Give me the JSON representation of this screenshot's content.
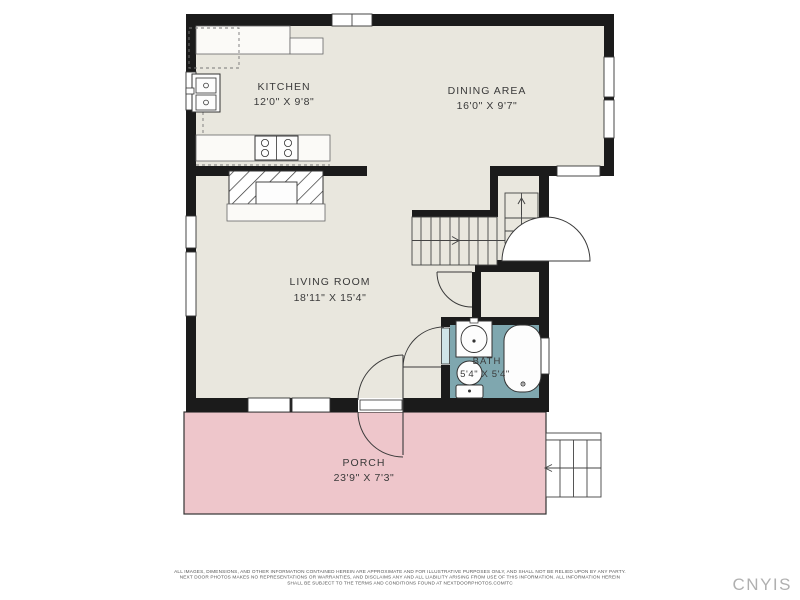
{
  "plan": {
    "rooms": [
      {
        "name": "KITCHEN",
        "dims": "12'0\" X 9'8\""
      },
      {
        "name": "DINING AREA",
        "dims": "16'0\" X 9'7\""
      },
      {
        "name": "LIVING ROOM",
        "dims": "18'11\" X 15'4\""
      },
      {
        "name": "BATH",
        "dims": "5'4\" X 5'4\""
      },
      {
        "name": "PORCH",
        "dims": "23'9\" X 7'3\""
      }
    ],
    "features": [
      "staircase-up",
      "basement-stair-door",
      "fireplace",
      "kitchen-sink",
      "range-stove",
      "bath-sink",
      "toilet",
      "bathtub",
      "front-entry-door",
      "porch-steps"
    ],
    "colors": {
      "wall": "#1b1b1b",
      "floor": "#e9e7de",
      "bath_floor": "#7fa7af",
      "porch_floor": "#eec6cb",
      "background": "#ffffff",
      "watermark": "#b0b0b0"
    }
  },
  "footer": {
    "disclaimer_line1": "ALL IMAGES, DIMENSIONS, AND OTHER INFORMATION CONTAINED HEREIN ARE APPROXIMATE AND FOR ILLUSTRATIVE PURPOSES ONLY, AND SHALL NOT BE RELIED UPON BY ANY PARTY.",
    "disclaimer_line2": "NEXT DOOR PHOTOS MAKES NO REPRESENTATIONS OR WARRANTIES, AND DISCLAIMS ANY AND ALL LIABILITY ARISING FROM USE OF THIS INFORMATION. ALL INFORMATION HEREIN",
    "disclaimer_line3": "SHALL BE SUBJECT TO THE TERMS AND CONDITIONS FOUND AT NEXTDOORPHOTOS.COM/TC",
    "watermark": "CNYIS"
  }
}
